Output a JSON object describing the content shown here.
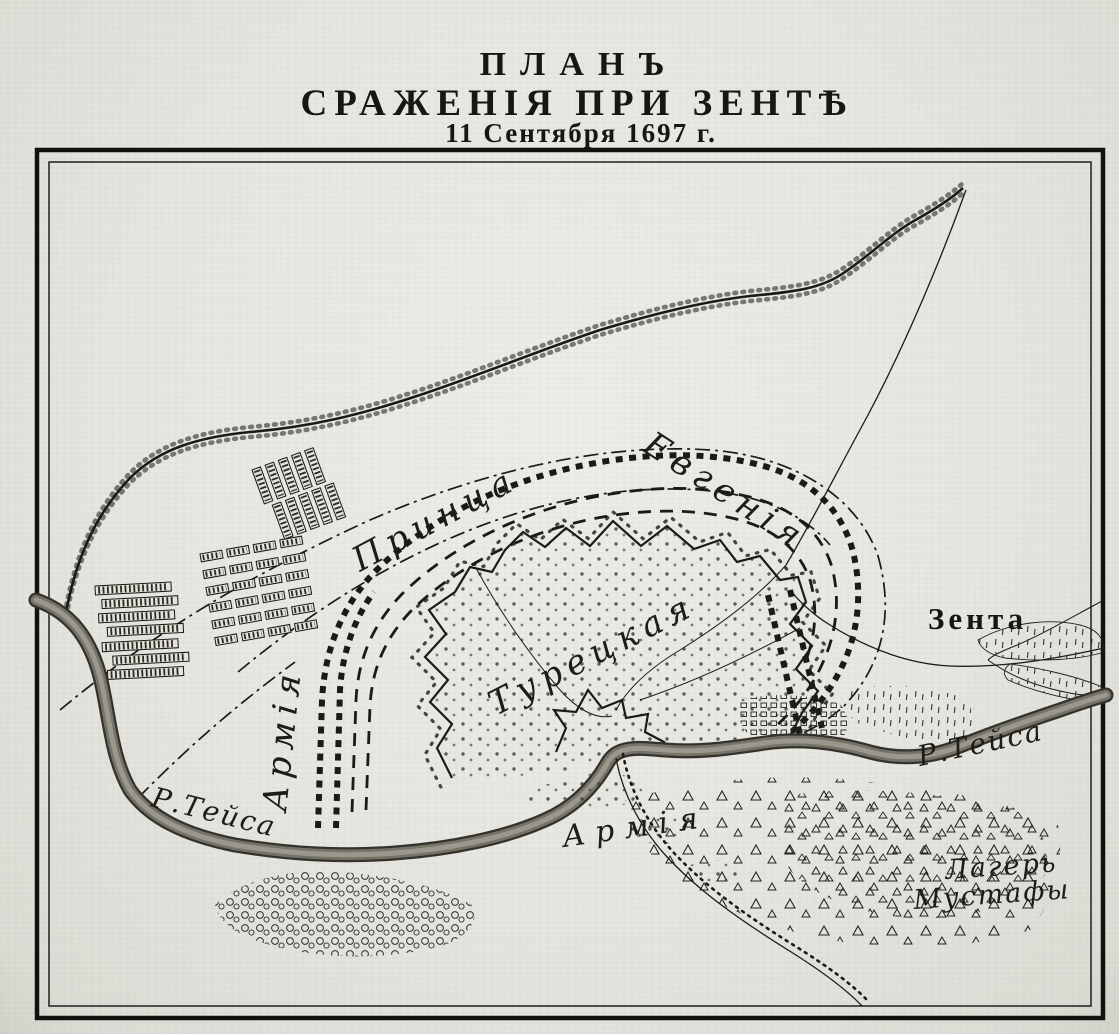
{
  "title": {
    "line1": "ПЛАНЪ",
    "line2": "СРАЖЕНІЯ ПРИ ЗЕНТѢ",
    "line3": "11 Сентября 1697 г."
  },
  "labels": {
    "army_prince_vertical": "Армія",
    "prince": "Принца",
    "eugene": "Евгенія",
    "turkish_camp": "Турецкая",
    "turkish_army": "Армія",
    "mustafa_line1": "Лагерь",
    "mustafa_line2": "Мустафы",
    "town_zenta": "Зента",
    "river_tisza_left": "Р.Тейса",
    "river_tisza_right": "Р.Тейса"
  },
  "colors": {
    "paper": "#e8e6e1",
    "ink": "#1b1a14",
    "river": "#767469"
  }
}
